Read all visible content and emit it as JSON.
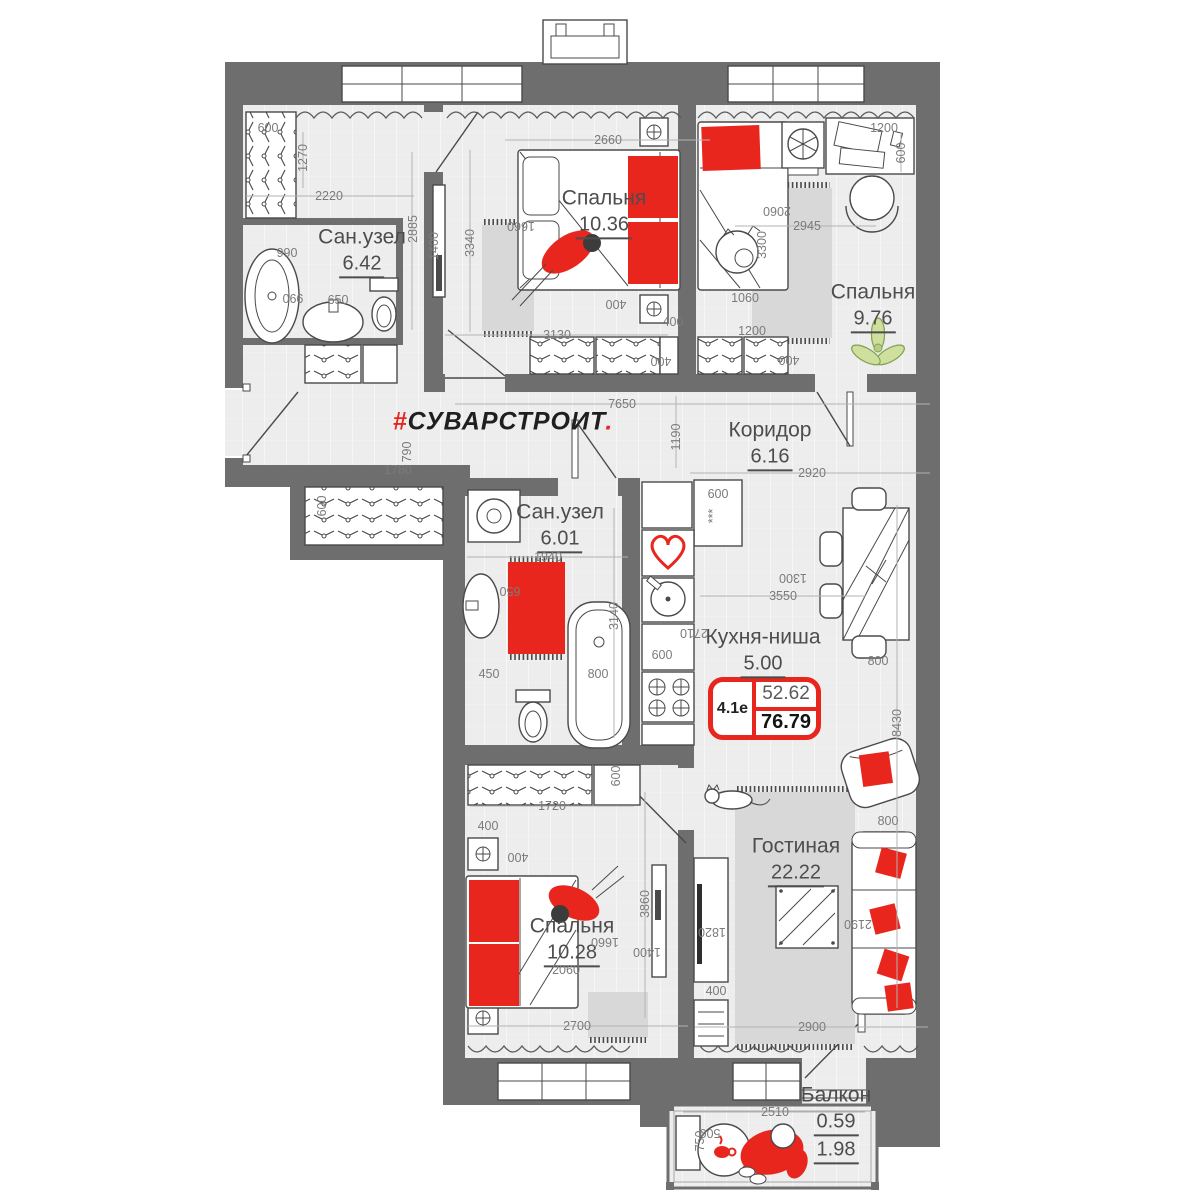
{
  "colors": {
    "wall": "#6e6e6e",
    "floor": "#ededed",
    "line": "#4a4a4a",
    "accent_red": "#e8261e",
    "rug_gray": "#d8d8d8",
    "plant_green": "#cfe09e",
    "dim_text": "#7b7b7b",
    "badge_border": "#e8261e"
  },
  "brand": {
    "prefix": "#",
    "name": "СУВАРСТРОИТ",
    "dot": "."
  },
  "badge": {
    "flat_type": "4.1е",
    "living_area": "52.62",
    "total_area": "76.79"
  },
  "icons": {
    "heart_icon": "red outlined heart on kitchen cabinet",
    "coffee_cup_icon": "red coffee cup on balcony table",
    "plant_icon": "green plant in bedroom corner"
  },
  "rooms": [
    {
      "id": "bedroom-1",
      "name": "Спальня",
      "area": "10.36",
      "x": 604,
      "y": 212
    },
    {
      "id": "bedroom-2",
      "name": "Спальня",
      "area": "9.76",
      "x": 873,
      "y": 306
    },
    {
      "id": "bathroom-1",
      "name": "Сан.узел",
      "area": "6.42",
      "x": 362,
      "y": 251
    },
    {
      "id": "bathroom-2",
      "name": "Сан.узел",
      "area": "6.01",
      "x": 560,
      "y": 526
    },
    {
      "id": "corridor",
      "name": "Коридор",
      "area": "6.16",
      "x": 770,
      "y": 444
    },
    {
      "id": "kitchen-niche",
      "name": "Кухня-ниша",
      "area": "5.00",
      "x": 763,
      "y": 651
    },
    {
      "id": "living-room",
      "name": "Гостиная",
      "area": "22.22",
      "x": 796,
      "y": 860
    },
    {
      "id": "bedroom-3",
      "name": "Спальня",
      "area": "10.28",
      "x": 572,
      "y": 940
    },
    {
      "id": "balcony",
      "name": "Балкон",
      "area": "0.59",
      "area2": "1.98",
      "x": 836,
      "y": 1123
    }
  ],
  "dimensions": [
    {
      "t": "600",
      "x": 268,
      "y": 128
    },
    {
      "t": "1270",
      "x": 303,
      "y": 158,
      "r": -90
    },
    {
      "t": "2220",
      "x": 329,
      "y": 196
    },
    {
      "t": "2885",
      "x": 413,
      "y": 229,
      "r": -90
    },
    {
      "t": "990",
      "x": 287,
      "y": 253
    },
    {
      "t": "990",
      "x": 293,
      "y": 298,
      "r": 180
    },
    {
      "t": "650",
      "x": 338,
      "y": 300
    },
    {
      "t": "790",
      "x": 407,
      "y": 452,
      "r": -90
    },
    {
      "t": "1780",
      "x": 398,
      "y": 470
    },
    {
      "t": "600",
      "x": 322,
      "y": 506,
      "r": -90
    },
    {
      "t": "2660",
      "x": 608,
      "y": 140
    },
    {
      "t": "1660",
      "x": 521,
      "y": 226,
      "r": 180
    },
    {
      "t": "1400",
      "x": 434,
      "y": 246,
      "r": -90
    },
    {
      "t": "3340",
      "x": 470,
      "y": 243,
      "r": -90
    },
    {
      "t": "400",
      "x": 616,
      "y": 304,
      "r": 180
    },
    {
      "t": "400",
      "x": 673,
      "y": 322
    },
    {
      "t": "3130",
      "x": 557,
      "y": 335
    },
    {
      "t": "400",
      "x": 661,
      "y": 361,
      "r": 180
    },
    {
      "t": "1200",
      "x": 884,
      "y": 128
    },
    {
      "t": "600",
      "x": 901,
      "y": 153,
      "r": -90
    },
    {
      "t": "2945",
      "x": 807,
      "y": 226
    },
    {
      "t": "2060",
      "x": 777,
      "y": 211,
      "r": 180
    },
    {
      "t": "3300",
      "x": 762,
      "y": 245,
      "r": -90
    },
    {
      "t": "1060",
      "x": 745,
      "y": 298
    },
    {
      "t": "1200",
      "x": 752,
      "y": 331
    },
    {
      "t": "400",
      "x": 789,
      "y": 360,
      "r": 180
    },
    {
      "t": "7650",
      "x": 622,
      "y": 404
    },
    {
      "t": "1190",
      "x": 676,
      "y": 437,
      "r": -90
    },
    {
      "t": "2920",
      "x": 812,
      "y": 473
    },
    {
      "t": "600",
      "x": 718,
      "y": 494
    },
    {
      "t": "***",
      "x": 713,
      "y": 516,
      "r": -90
    },
    {
      "t": "1940",
      "x": 548,
      "y": 557
    },
    {
      "t": "650",
      "x": 510,
      "y": 591,
      "r": 180
    },
    {
      "t": "3140",
      "x": 614,
      "y": 616,
      "r": -90
    },
    {
      "t": "450",
      "x": 489,
      "y": 674
    },
    {
      "t": "800",
      "x": 598,
      "y": 674
    },
    {
      "t": "2710",
      "x": 694,
      "y": 633,
      "r": 180
    },
    {
      "t": "600",
      "x": 662,
      "y": 655
    },
    {
      "t": "3550",
      "x": 783,
      "y": 596
    },
    {
      "t": "1300",
      "x": 793,
      "y": 578,
      "r": 180
    },
    {
      "t": "800",
      "x": 878,
      "y": 661
    },
    {
      "t": "8430",
      "x": 897,
      "y": 723,
      "r": -90
    },
    {
      "t": "800",
      "x": 888,
      "y": 821
    },
    {
      "t": "2190",
      "x": 858,
      "y": 924,
      "r": 180
    },
    {
      "t": "1820",
      "x": 712,
      "y": 932,
      "r": 180
    },
    {
      "t": "400",
      "x": 716,
      "y": 991
    },
    {
      "t": "2900",
      "x": 812,
      "y": 1027
    },
    {
      "t": "600",
      "x": 616,
      "y": 776,
      "r": -90
    },
    {
      "t": "1720",
      "x": 552,
      "y": 806
    },
    {
      "t": "400",
      "x": 488,
      "y": 826
    },
    {
      "t": "400",
      "x": 518,
      "y": 857,
      "r": 180
    },
    {
      "t": "3860",
      "x": 645,
      "y": 904,
      "r": -90
    },
    {
      "t": "1660",
      "x": 605,
      "y": 942,
      "r": 180
    },
    {
      "t": "1400",
      "x": 647,
      "y": 952,
      "r": 180
    },
    {
      "t": "2060",
      "x": 566,
      "y": 970
    },
    {
      "t": "2700",
      "x": 577,
      "y": 1026
    },
    {
      "t": "2510",
      "x": 775,
      "y": 1112
    },
    {
      "t": "750",
      "x": 700,
      "y": 1141,
      "r": -90
    },
    {
      "t": "500",
      "x": 710,
      "y": 1133,
      "r": 180
    }
  ]
}
